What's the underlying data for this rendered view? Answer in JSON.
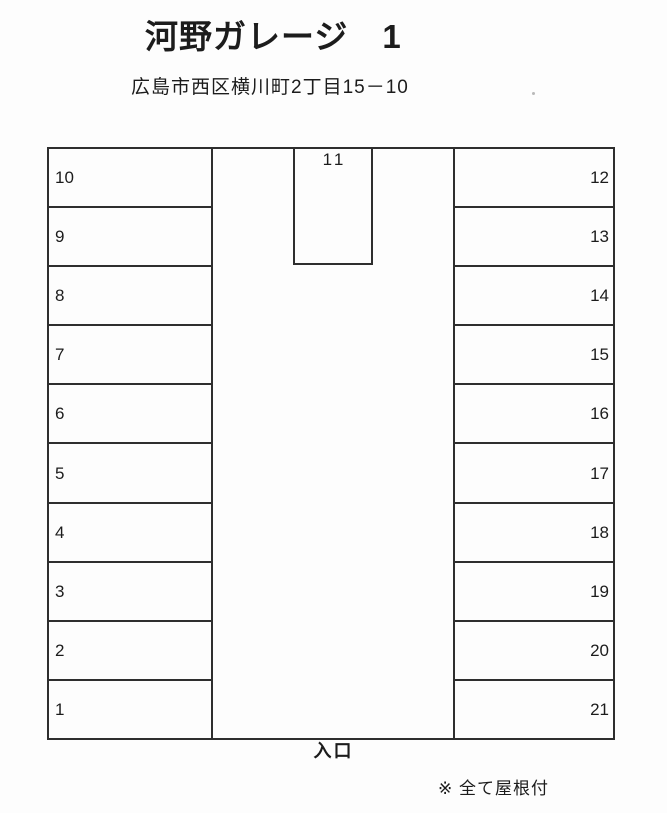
{
  "header": {
    "title": "河野ガレージ　1",
    "address": "広島市西区横川町2丁目15－10"
  },
  "lot": {
    "left_spaces": [
      "10",
      "9",
      "8",
      "7",
      "6",
      "5",
      "4",
      "3",
      "2",
      "1"
    ],
    "right_spaces": [
      "12",
      "13",
      "14",
      "15",
      "16",
      "17",
      "18",
      "19",
      "20",
      "21"
    ],
    "middle_space": "11",
    "entrance_label": "入口"
  },
  "footer": {
    "note": "※ 全て屋根付"
  },
  "colors": {
    "line": "#2e2e2e",
    "text": "#1c1c1c",
    "background": "#fdfdfd"
  }
}
